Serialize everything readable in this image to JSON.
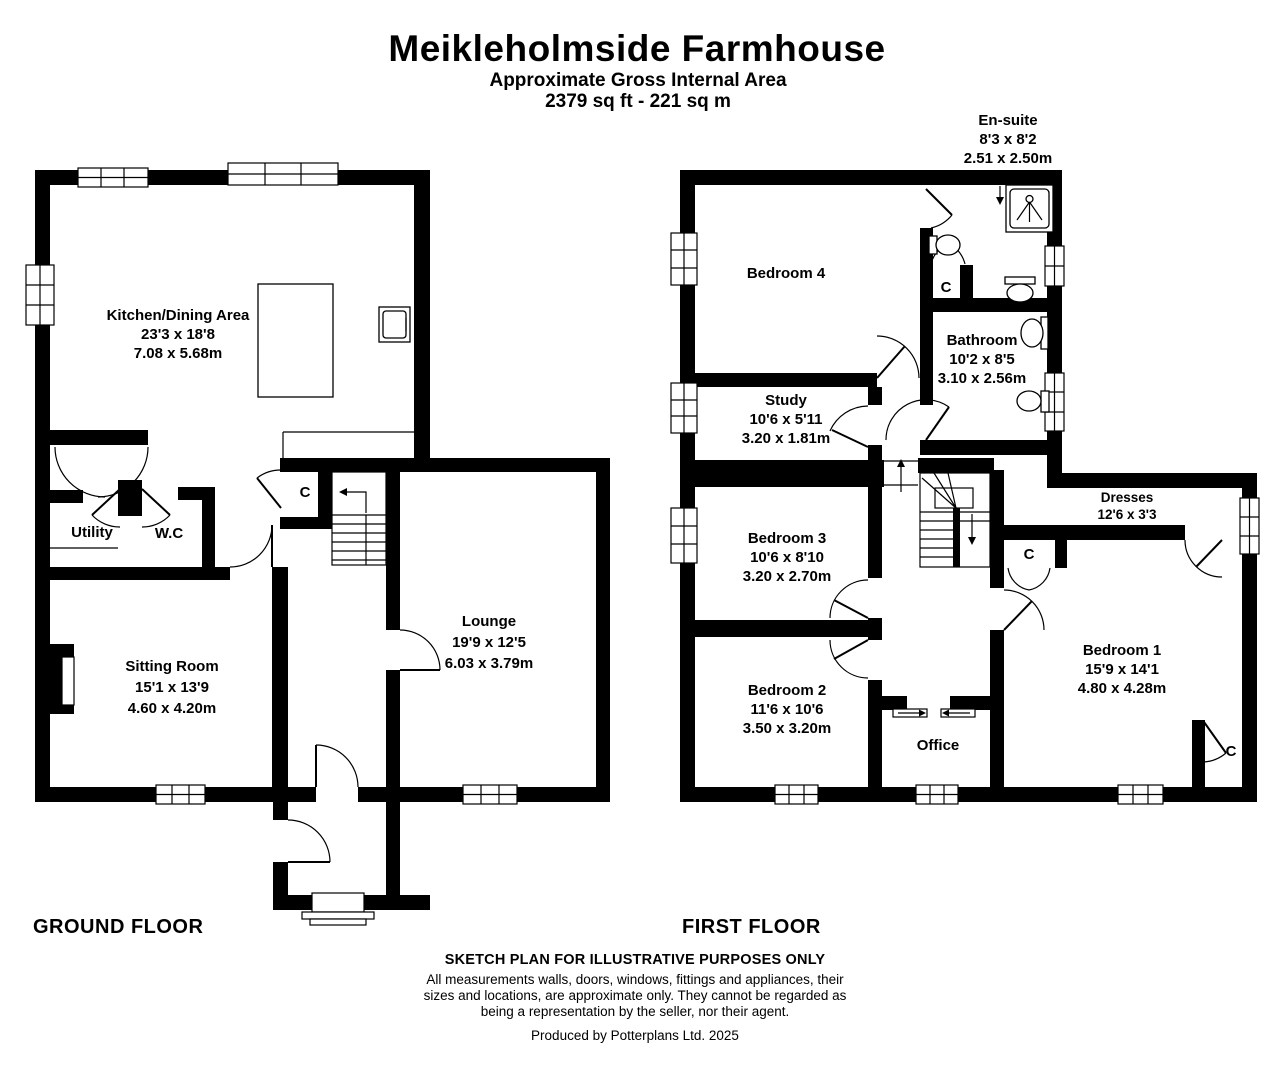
{
  "header": {
    "title": "Meikleholmside Farmhouse",
    "subtitle": "Approximate Gross Internal Area",
    "area": "2379 sq ft - 221 sq m"
  },
  "ground_floor": {
    "label": "GROUND FLOOR",
    "rooms": {
      "kitchen": {
        "name": "Kitchen/Dining Area",
        "imperial": "23'3 x 18'8",
        "metric": "7.08 x 5.68m"
      },
      "utility": {
        "name": "Utility"
      },
      "wc": {
        "name": "W.C"
      },
      "sitting": {
        "name": "Sitting Room",
        "imperial": "15'1 x 13'9",
        "metric": "4.60 x 4.20m"
      },
      "lounge": {
        "name": "Lounge",
        "imperial": "19'9 x 12'5",
        "metric": "6.03 x 3.79m"
      },
      "cupboard": {
        "name": "C"
      }
    },
    "fixtures": [
      "kitchen-island",
      "kitchen-sink-icon",
      "fireplace-icon",
      "staircase",
      "entrance-steps"
    ]
  },
  "first_floor": {
    "label": "FIRST FLOOR",
    "rooms": {
      "bedroom4": {
        "name": "Bedroom 4"
      },
      "ensuite": {
        "name": "En-suite",
        "imperial": "8'3 x 8'2",
        "metric": "2.51 x 2.50m"
      },
      "ensuite_cupboard": {
        "name": "C"
      },
      "bathroom": {
        "name": "Bathroom",
        "imperial": "10'2 x 8'5",
        "metric": "3.10 x 2.56m"
      },
      "study": {
        "name": "Study",
        "imperial": "10'6 x 5'11",
        "metric": "3.20 x 1.81m"
      },
      "bedroom3": {
        "name": "Bedroom 3",
        "imperial": "10'6 x 8'10",
        "metric": "3.20 x 2.70m"
      },
      "bedroom2": {
        "name": "Bedroom 2",
        "imperial": "11'6 x 10'6",
        "metric": "3.50 x 3.20m"
      },
      "office": {
        "name": "Office"
      },
      "dresses": {
        "name": "Dresses",
        "imperial": "12'6 x 3'3",
        "metric": "3.80 x 1.00m"
      },
      "bedroom1": {
        "name": "Bedroom 1",
        "imperial": "15'9 x 14'1",
        "metric": "4.80 x 4.28m"
      },
      "landing_cupboard": {
        "name": "C"
      },
      "bedroom1_cupboard": {
        "name": "C"
      }
    },
    "fixtures": [
      "shower-icon",
      "toilet-icon",
      "basin-icon",
      "staircase",
      "sliding-doors"
    ]
  },
  "footer": {
    "disclaimer_title": "SKETCH PLAN FOR ILLUSTRATIVE PURPOSES ONLY",
    "disclaimer_lines": [
      "All measurements walls, doors, windows, fittings and appliances, their",
      "sizes and locations, are approximate only. They cannot be regarded as",
      "being a representation by the seller, nor their agent."
    ],
    "credit": "Produced by Potterplans Ltd. 2025"
  },
  "colors": {
    "wall": "#000000",
    "background": "#ffffff",
    "text": "#000000"
  }
}
